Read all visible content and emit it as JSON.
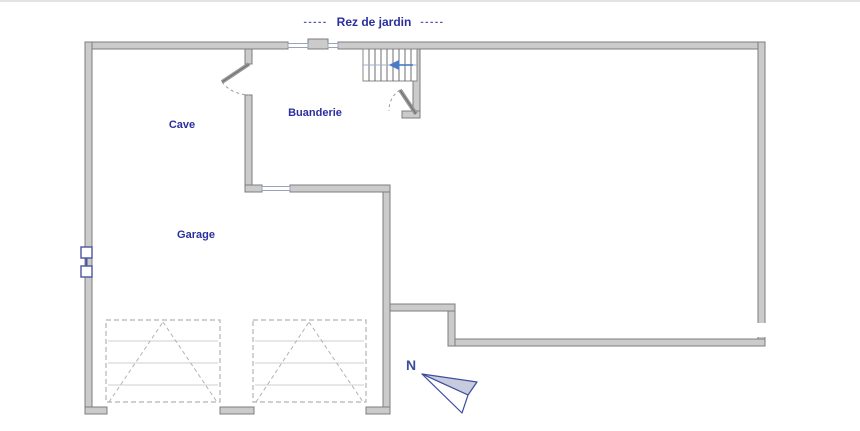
{
  "title": {
    "prefix": "-----",
    "text": "Rez de jardin",
    "suffix": "-----"
  },
  "rooms": {
    "cave": {
      "label": "Cave"
    },
    "buanderie": {
      "label": "Buanderie"
    },
    "garage": {
      "label": "Garage"
    }
  },
  "compass": {
    "label": "N",
    "direction": "up-left"
  },
  "stair": {
    "arrow_direction": "left",
    "tread_count": 9
  },
  "garage_doors": {
    "count": 2,
    "style": "dashed sectional door symbol"
  },
  "colors": {
    "wall_fill": "#cbcbcb",
    "wall_stroke": "#7d7d7d",
    "label_color": "#2b2f9e",
    "compass_color": "#3f4d9e",
    "compass_fill": "#c6cbde",
    "stair_arrow": "#4a7bc8",
    "stair_guide": "#9fb0cf",
    "door_dash": "#b3b3b3",
    "fixture_color": "#4a55a2"
  }
}
